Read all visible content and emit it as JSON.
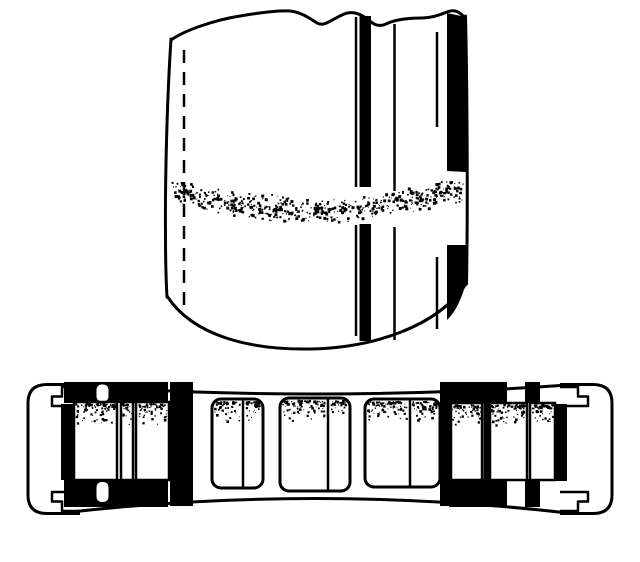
{
  "drawing": {
    "background_color": "#ffffff",
    "ink_color": "#000000",
    "views": [
      {
        "id": "cylinder-elevation",
        "black_stripe_count": 2,
        "thin_line_count": 3,
        "dashed_line_count": 1,
        "stipple_band_count": 1
      },
      {
        "id": "ring-cross-section",
        "end_cap_count": 2,
        "cell_group_count": 5,
        "white_cell_count": 12,
        "black_divider_count": 2
      }
    ]
  }
}
